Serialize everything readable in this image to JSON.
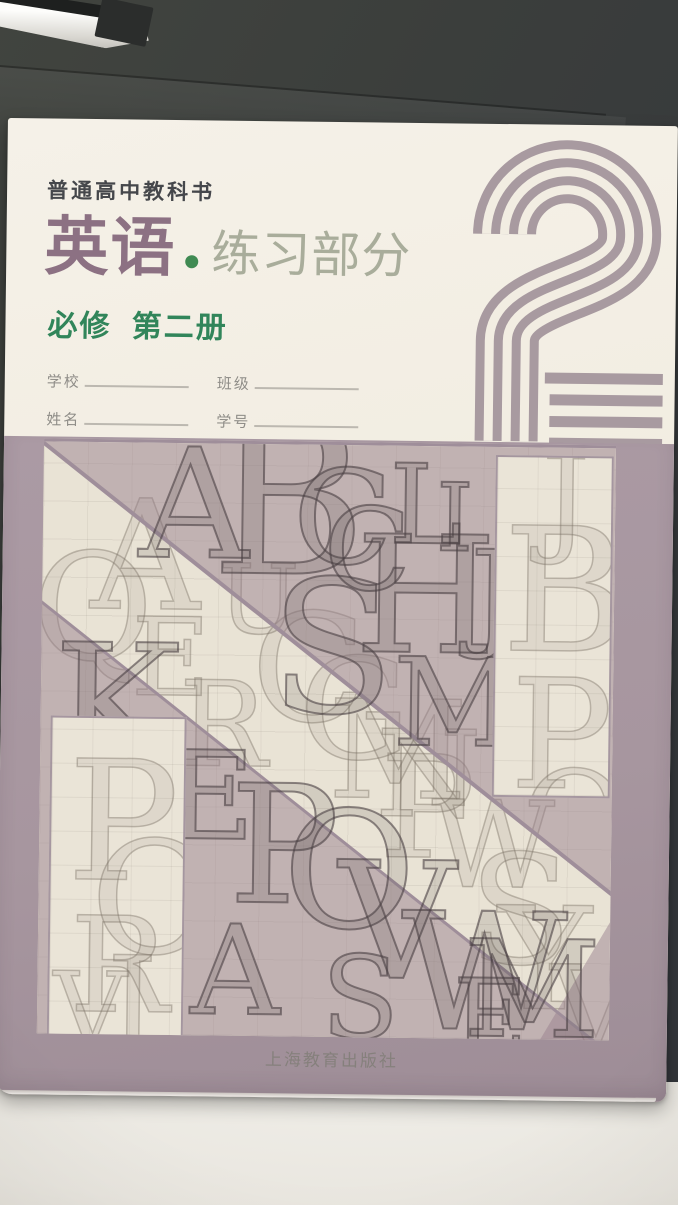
{
  "scene": {
    "setting": "book lying on a desk",
    "background_dark": "#3a3d3b",
    "desk_light": "#eae8e3"
  },
  "book": {
    "series_label": "普通高中教科书",
    "title": "英语",
    "separator": "·",
    "subtitle": "练习部分",
    "edition": "必修 第二册",
    "form": {
      "rows": [
        [
          "学校",
          "班级"
        ],
        [
          "姓名",
          "学号"
        ]
      ]
    },
    "numeral": {
      "value": "2",
      "stripes": 4,
      "color": "#a89aa0"
    },
    "publisher": "上海教育出版社"
  },
  "collage": {
    "style": "engraved construction sketches of Latin capital letters on diagonal cream and mauve bands",
    "letters": {
      "pale": [
        [
          "A",
          48,
          38,
          152
        ],
        [
          "Q",
          -10,
          92,
          148
        ],
        [
          "E",
          90,
          162,
          108
        ],
        [
          "R",
          138,
          222,
          118
        ],
        [
          "U",
          176,
          108,
          96
        ],
        [
          "C",
          210,
          150,
          150
        ],
        [
          "G",
          258,
          196,
          140
        ],
        [
          "M",
          288,
          238,
          136
        ],
        [
          "N",
          336,
          270,
          120
        ],
        [
          "P",
          340,
          292,
          142
        ],
        [
          "W",
          392,
          340,
          120
        ],
        [
          "S",
          430,
          388,
          152
        ],
        [
          "Y",
          460,
          442,
          142
        ],
        [
          "V",
          513,
          502,
          118
        ]
      ],
      "ink": [
        [
          "A",
          96,
          -14,
          152
        ],
        [
          "B",
          168,
          -50,
          212
        ],
        [
          "C",
          250,
          8,
          130
        ],
        [
          "L",
          346,
          4,
          110
        ],
        [
          "H",
          313,
          70,
          162
        ],
        [
          "S",
          228,
          112,
          184
        ],
        [
          "C",
          281,
          48,
          114
        ],
        [
          "I",
          393,
          26,
          94
        ],
        [
          "J",
          428,
          88,
          118
        ],
        [
          "M",
          352,
          196,
          122
        ],
        [
          "E",
          126,
          292,
          122
        ],
        [
          "K",
          12,
          180,
          172
        ],
        [
          "P",
          190,
          320,
          164
        ],
        [
          "O",
          244,
          346,
          162
        ],
        [
          "V",
          300,
          396,
          162
        ],
        [
          "W",
          363,
          446,
          162
        ],
        [
          "S",
          284,
          496,
          114
        ],
        [
          "A",
          153,
          466,
          124
        ],
        [
          "M",
          426,
          476,
          134
        ],
        [
          "E",
          416,
          520,
          102
        ]
      ],
      "patch_tr": [
        [
          "J",
          44,
          -18,
          120
        ],
        [
          "B",
          6,
          48,
          172
        ],
        [
          "P",
          16,
          202,
          152
        ],
        [
          "O",
          28,
          296,
          130
        ]
      ],
      "patch_bl": [
        [
          "P",
          16,
          22,
          166
        ],
        [
          "O",
          40,
          102,
          156
        ],
        [
          "R",
          20,
          182,
          132
        ],
        [
          "J",
          58,
          222,
          122
        ],
        [
          "V",
          4,
          242,
          102
        ]
      ]
    }
  },
  "colors": {
    "cover_cream": "#f2ede2",
    "title_purple": "#8c7183",
    "subtitle_sage": "#a9ad9b",
    "series_dark": "#45474b",
    "edition_green": "#31855a",
    "dot_green": "#3f8a52",
    "numeral_mauve": "#a89aa0",
    "field_mauve": "#a7969f",
    "collage_cream": "#e9e3d5",
    "collage_tint": "#b7a8ae",
    "divider_mauve": "#9f8e9a",
    "form_gray": "#8f8d88",
    "publisher_gray": "#85807c"
  }
}
